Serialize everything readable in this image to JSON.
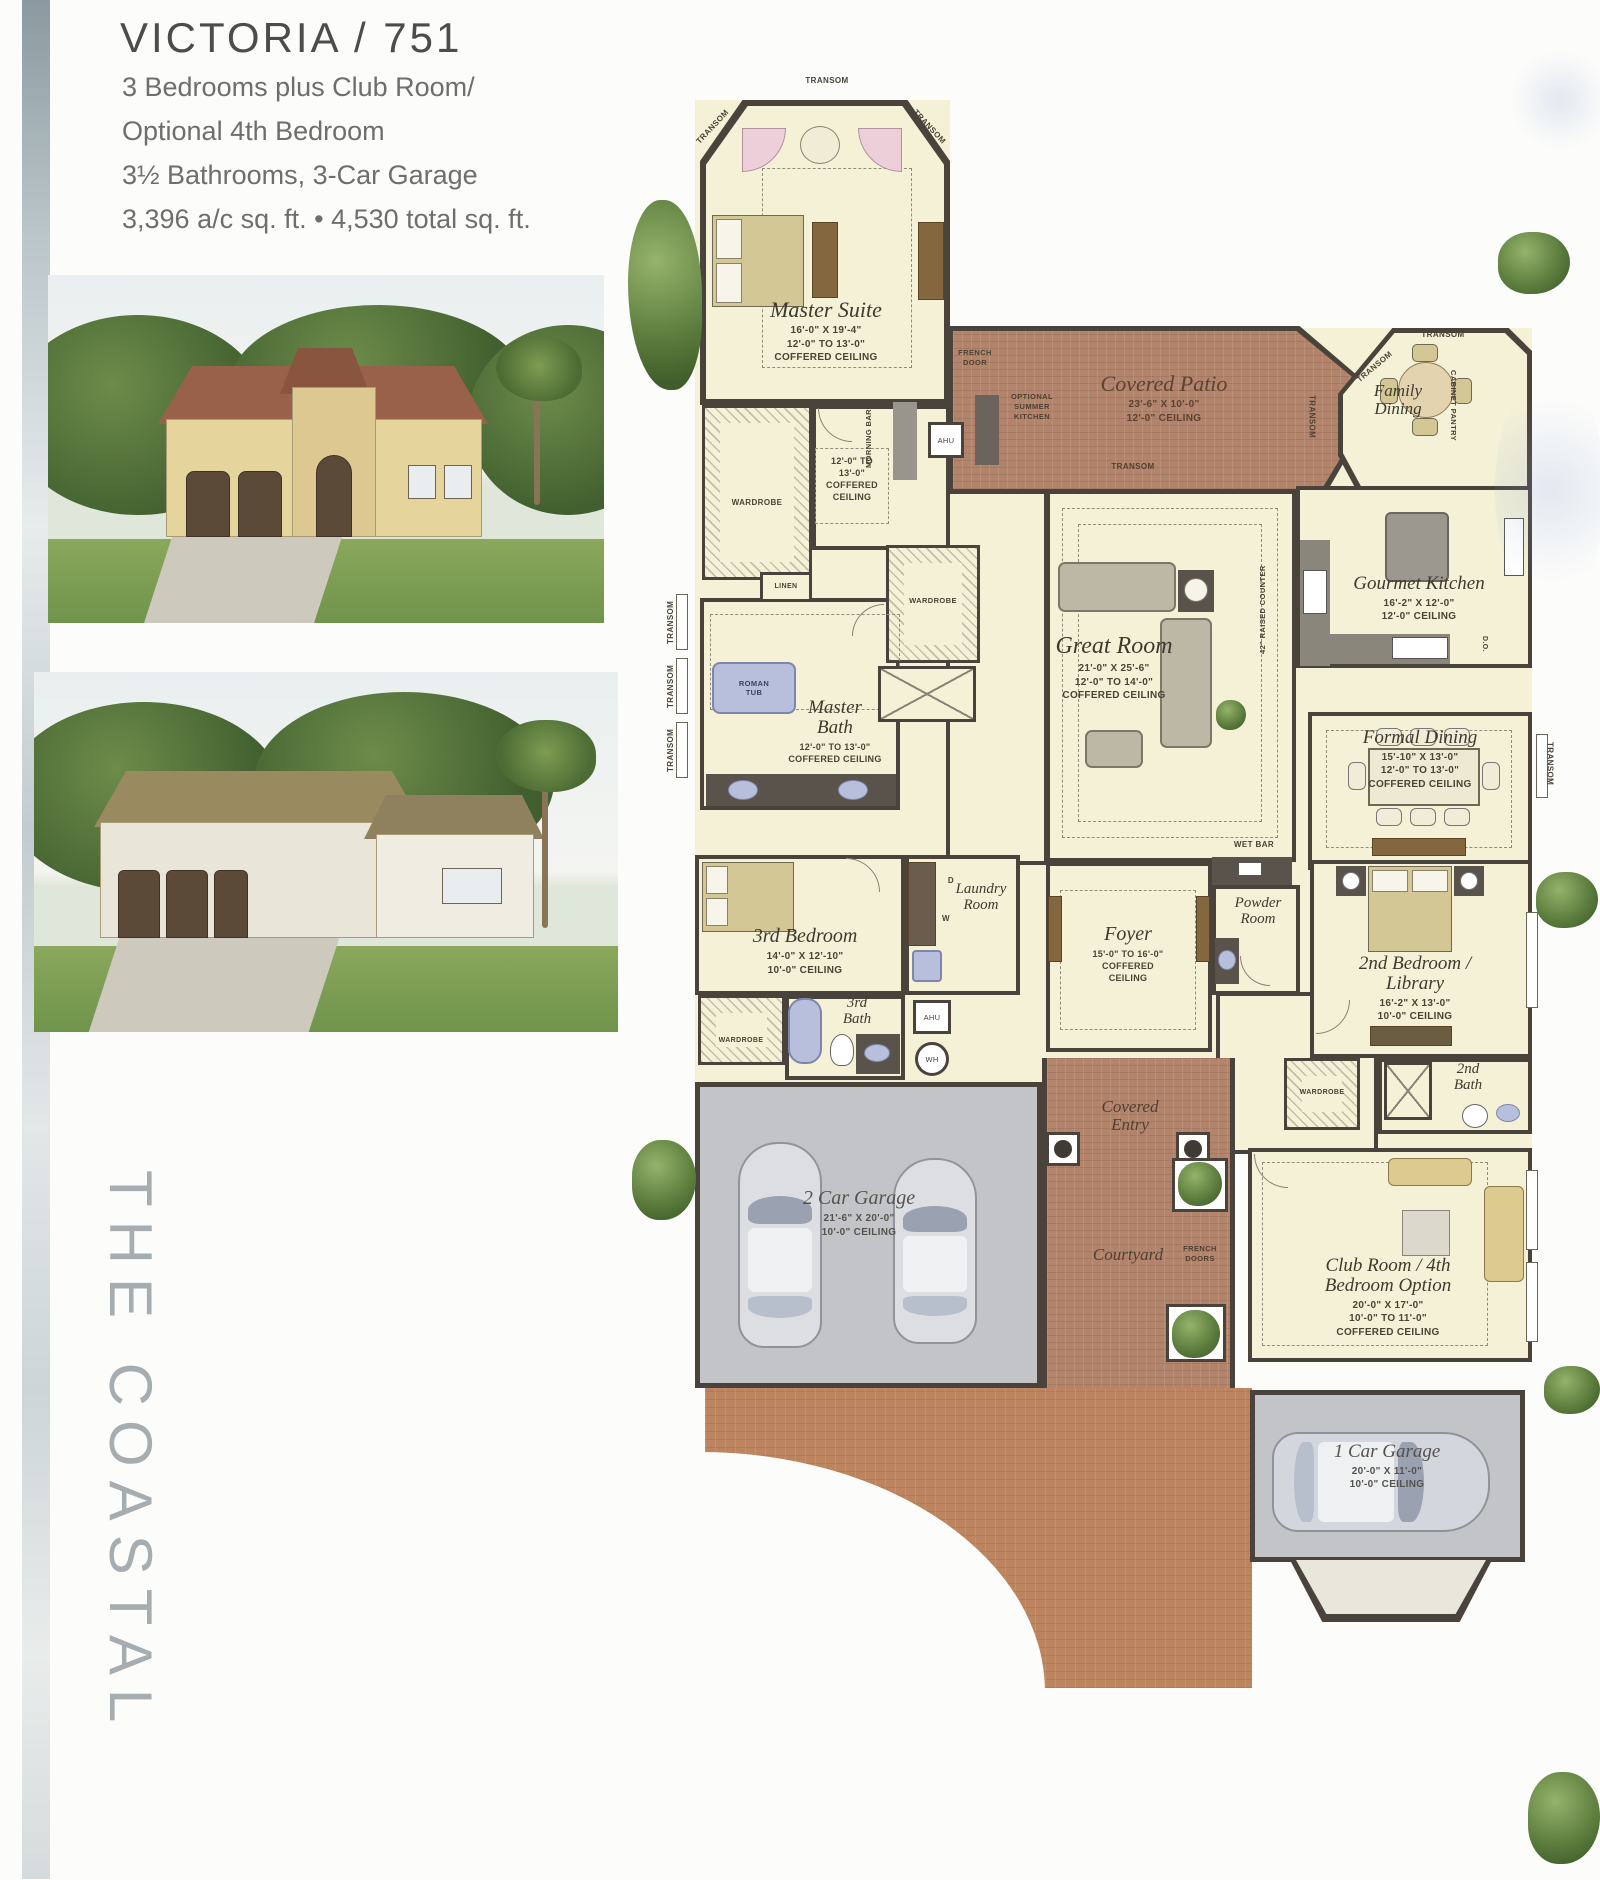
{
  "header": {
    "title": "VICTORIA / 751",
    "line1": "3 Bedrooms plus Club Room/",
    "line2": "Optional 4th Bedroom",
    "line3": "3½ Bathrooms, 3-Car Garage",
    "line4": "3,396 a/c sq. ft. • 4,530 total sq. ft."
  },
  "sidebar": {
    "series": "THE COASTAL"
  },
  "fp": {
    "master": {
      "name": "Master Suite",
      "dims": "16'-0\" X 19'-4\"",
      "ceil": "12'-0\" TO 13'-0\"",
      "ctype": "COFFERED CEILING"
    },
    "sitting": {
      "l1": "12'-0\" TO",
      "l2": "13'-0\"",
      "l3": "COFFERED",
      "l4": "CEILING"
    },
    "patio": {
      "name": "Covered Patio",
      "dims": "23'-6\" X 10'-0\"",
      "ceil": "12'-0\" CEILING"
    },
    "family": {
      "l1": "Family",
      "l2": "Dining"
    },
    "kitchen": {
      "name": "Gourmet Kitchen",
      "dims": "16'-2\" X 12'-0\"",
      "ceil": "12'-0\" CEILING"
    },
    "great": {
      "name": "Great Room",
      "dims": "21'-0\" X 25'-6\"",
      "ceil": "12'-0\" TO 14'-0\"",
      "ctype": "COFFERED CEILING"
    },
    "formal": {
      "name": "Formal Dining",
      "dims": "15'-10\" X 13'-0\"",
      "ceil": "12'-0\" TO 13'-0\"",
      "ctype": "COFFERED CEILING"
    },
    "mbath": {
      "l1": "Master",
      "l2": "Bath",
      "ceil": "12'-0\" TO 13'-0\"",
      "ctype": "COFFERED CEILING"
    },
    "bed3": {
      "name": "3rd Bedroom",
      "dims": "14'-0\" X 12'-10\"",
      "ceil": "10'-0\" CEILING"
    },
    "bath3": {
      "l1": "3rd",
      "l2": "Bath"
    },
    "laundry": {
      "l1": "Laundry",
      "l2": "Room"
    },
    "foyer": {
      "name": "Foyer",
      "ceil": "15'-0\" TO 16'-0\"",
      "l2": "COFFERED",
      "l3": "CEILING"
    },
    "powder": {
      "l1": "Powder",
      "l2": "Room"
    },
    "bed2": {
      "l1": "2nd Bedroom /",
      "l2": "Library",
      "dims": "16'-2\" X 13'-0\"",
      "ceil": "10'-0\" CEILING"
    },
    "bath2": {
      "l1": "2nd",
      "l2": "Bath"
    },
    "garage2": {
      "name": "2 Car Garage",
      "dims": "21'-6\" X 20'-0\"",
      "ceil": "10'-0\" CEILING"
    },
    "entry": {
      "l1": "Covered",
      "l2": "Entry"
    },
    "courtyard": {
      "name": "Courtyard"
    },
    "club": {
      "l1": "Club Room / 4th",
      "l2": "Bedroom Option",
      "dims": "20'-0\" X 17'-0\"",
      "ceil": "10'-0\" TO 11'-0\"",
      "ctype": "COFFERED CEILING"
    },
    "garage1": {
      "name": "1 Car Garage",
      "dims": "20'-0\" X 11'-0\"",
      "ceil": "10'-0\" CEILING"
    },
    "labels": {
      "transom": "TRANSOM",
      "wardrobe": "WARDROBE",
      "linen": "LINEN",
      "roman_tub": "ROMAN TUB",
      "morning_bar": "MORNING BAR",
      "french_door": "FRENCH DOOR",
      "french_doors": "FRENCH DOORS",
      "summer_kitchen": "OPTIONAL SUMMER KITCHEN",
      "cabinet_pantry": "CABINET PANTRY",
      "raised_counter": "42\" RAISED COUNTER",
      "wet_bar": "WET BAR",
      "ahu": "AHU",
      "wh": "WH",
      "do": "D.O.",
      "washer": "W",
      "dryer": "D"
    }
  },
  "colors": {
    "wall": "#4a433c",
    "floor": "#f4f1d7",
    "brick": "#b3846c",
    "brick2": "#bc8560",
    "garage_floor": "#c3c4c8",
    "fixture_blue": "#b7bfdd",
    "tree_green": "#5d7e3e",
    "series_gray": "#a6adb1"
  }
}
